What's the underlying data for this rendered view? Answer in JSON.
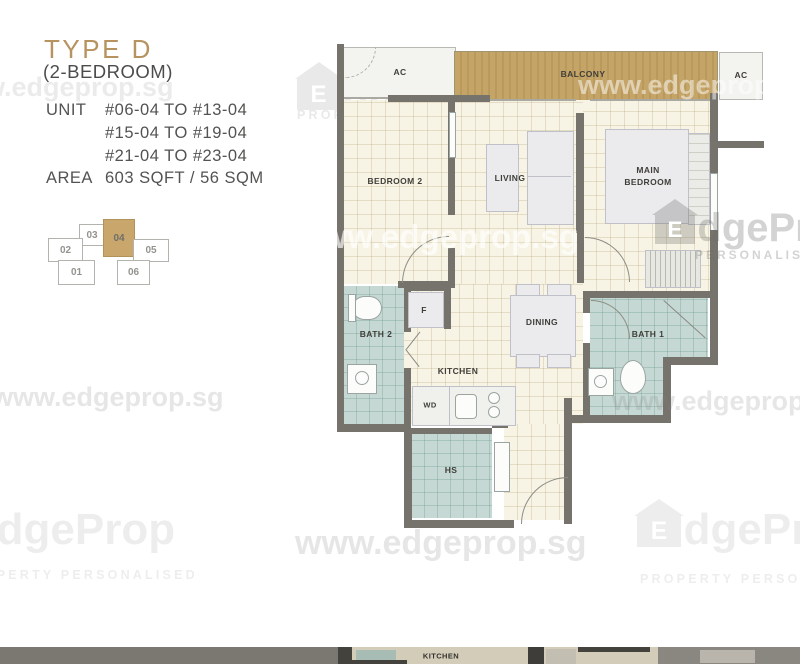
{
  "header": {
    "type_label": "TYPE D",
    "subtitle": "(2-BEDROOM)",
    "unit_label": "UNIT",
    "unit_ranges": [
      "#06-04 TO #13-04",
      "#15-04 TO #19-04",
      "#21-04 TO #23-04"
    ],
    "area_label": "AREA",
    "area_value": "603 SQFT / 56 SQM"
  },
  "key_plan": {
    "highlighted_unit": "04",
    "units": [
      {
        "label": "03"
      },
      {
        "label": "04"
      },
      {
        "label": "02"
      },
      {
        "label": "05"
      },
      {
        "label": "01"
      },
      {
        "label": "06"
      }
    ]
  },
  "floor_plan": {
    "rooms": {
      "ac_left": "AC",
      "balcony": "BALCONY",
      "ac_right": "AC",
      "bedroom2": "BEDROOM 2",
      "living": "LIVING",
      "main_bedroom_line1": "MAIN",
      "main_bedroom_line2": "BEDROOM",
      "bath2": "BATH 2",
      "fridge": "F",
      "dining": "DINING",
      "bath1": "BATH 1",
      "kitchen": "KITCHEN",
      "washer_dryer": "WD",
      "household_shelter": "HS"
    }
  },
  "next_plan_strip": {
    "kitchen": "KITCHEN"
  },
  "watermarks": {
    "url": "www.edgeprop.sg",
    "brand_initial": "E",
    "brand_rest": "dgeProp",
    "tagline": "PROPERTY PERSONALISED",
    "tagline_right": "PERSONALISED"
  },
  "colors": {
    "accent_tan": "#b6935f",
    "balcony_fill": "#c3a466",
    "wall": "#76726c",
    "bath_teal": "#c5d8d3",
    "floor_cream": "#f8f4e5",
    "key_plan_highlight": "#c9a66b"
  }
}
